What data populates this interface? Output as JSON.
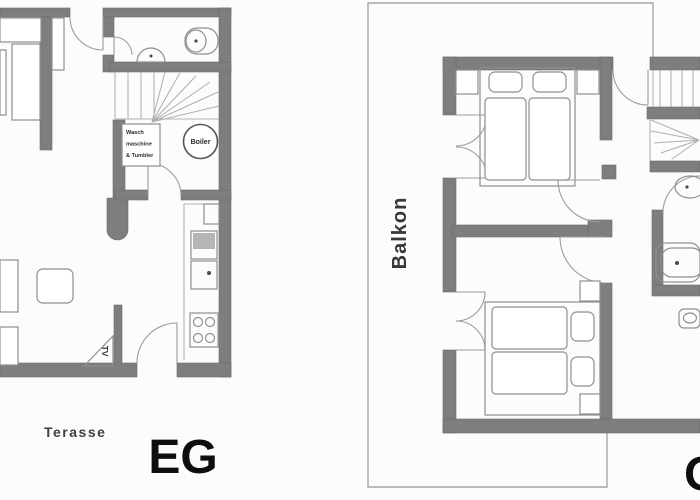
{
  "floors": {
    "ground": {
      "label": "EG",
      "terrace_label": "Terasse",
      "laundry_box": {
        "line1": "Wasch",
        "line2": "maschine",
        "line3": "& Tumbler"
      },
      "boiler_label": "Boiler",
      "tv_label": "TV"
    },
    "upper": {
      "label": "OG",
      "balcony_label": "Balkon"
    }
  },
  "colors": {
    "wall": "#7e7e7e",
    "furniture_line": "#8f8f8f",
    "door_line": "#9c9c9c",
    "balcony_outline": "#a6a6a6",
    "label_text": "#0e0e0e",
    "secondary_text": "#3f3f3f",
    "background": "#fcfcfc"
  }
}
